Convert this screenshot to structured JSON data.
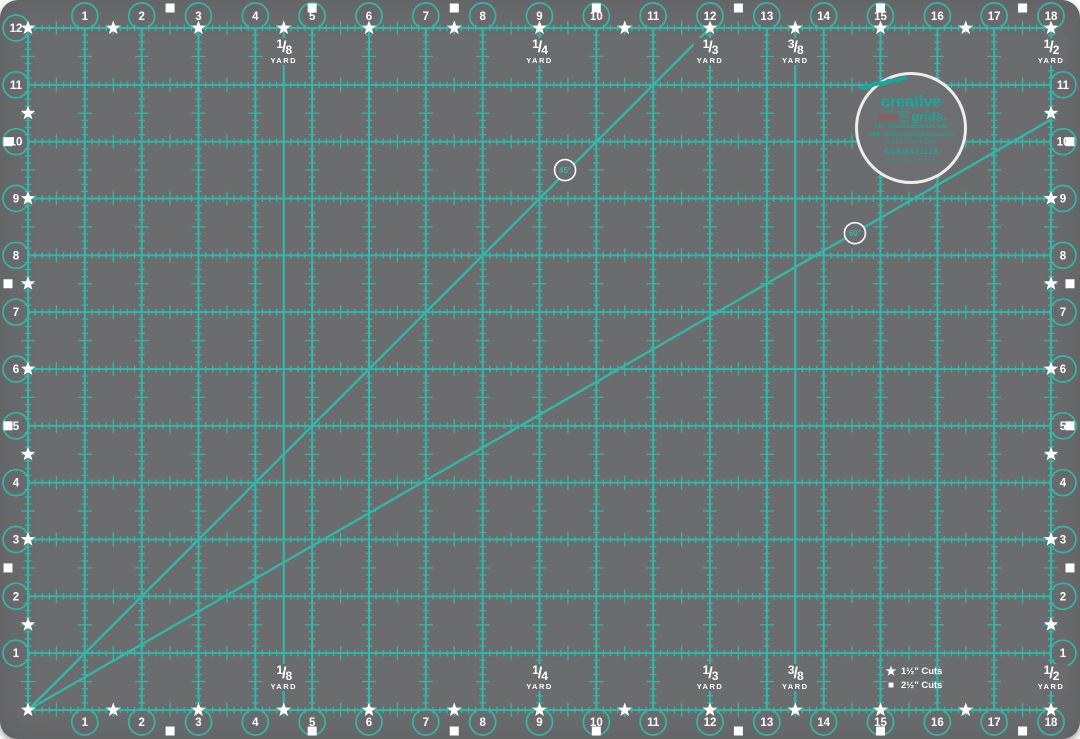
{
  "colors": {
    "mat": "#6a6c6d",
    "grid": "#34b7a9",
    "white": "#ffffff",
    "red": "#cf3a36",
    "logo_teal": "#17a89b"
  },
  "grid": {
    "inches_w": 18,
    "inches_h": 12,
    "star_interval_in": 1.5,
    "square_interval_in": 2.5
  },
  "numbers": {
    "top": [
      1,
      2,
      3,
      4,
      5,
      6,
      7,
      8,
      9,
      10,
      11,
      12,
      13,
      14,
      15,
      16,
      17,
      18
    ],
    "bottom": [
      1,
      2,
      3,
      4,
      5,
      6,
      7,
      8,
      9,
      10,
      11,
      12,
      13,
      14,
      15,
      16,
      17,
      18
    ],
    "left": [
      12,
      11,
      10,
      9,
      8,
      7,
      6,
      5,
      4,
      3,
      2,
      1
    ],
    "right": [
      11,
      10,
      9,
      8,
      7,
      6,
      5,
      4,
      3,
      2,
      1
    ]
  },
  "yard_marks": [
    {
      "fraction": "1/8",
      "word": "YARD",
      "position_in": 4.5,
      "full_line": true
    },
    {
      "fraction": "1/4",
      "word": "YARD",
      "position_in": 9,
      "full_line": false
    },
    {
      "fraction": "1/3",
      "word": "YARD",
      "position_in": 12,
      "full_line": false
    },
    {
      "fraction": "3/8",
      "word": "YARD",
      "position_in": 13.5,
      "full_line": true
    },
    {
      "fraction": "1/2",
      "word": "YARD",
      "position_in": 18,
      "full_line": false
    }
  ],
  "angle_lines": [
    {
      "label": "45°",
      "end_in": {
        "x": 12,
        "y": 12
      },
      "badge_in": {
        "x": 9.45,
        "y": 9.5
      }
    },
    {
      "label": "60°",
      "end_in": {
        "x": 18,
        "y": 10.39
      },
      "badge_in": {
        "x": 14.55,
        "y": 8.39
      }
    }
  ],
  "legend": {
    "items": [
      {
        "glyph": "★",
        "label": "1½\" Cuts"
      },
      {
        "glyph": "■",
        "label": "2½\" Cuts"
      }
    ]
  },
  "logo": {
    "brand_top": "creative",
    "brand_bottom": "grids",
    "reg": "®",
    "tagline_pre": "The original",
    "tagline_accent": "NON-SLIP",
    "tagline_post": "ruler from",
    "url_uk": "UK : www.creativegrids.com",
    "url_usa": "USA : www.creativegridsusa.com",
    "copyright": "© 2014 Creative Grids",
    "product_code": "CGRMAT1218",
    "made_in": "MADE IN TAIWAN"
  }
}
